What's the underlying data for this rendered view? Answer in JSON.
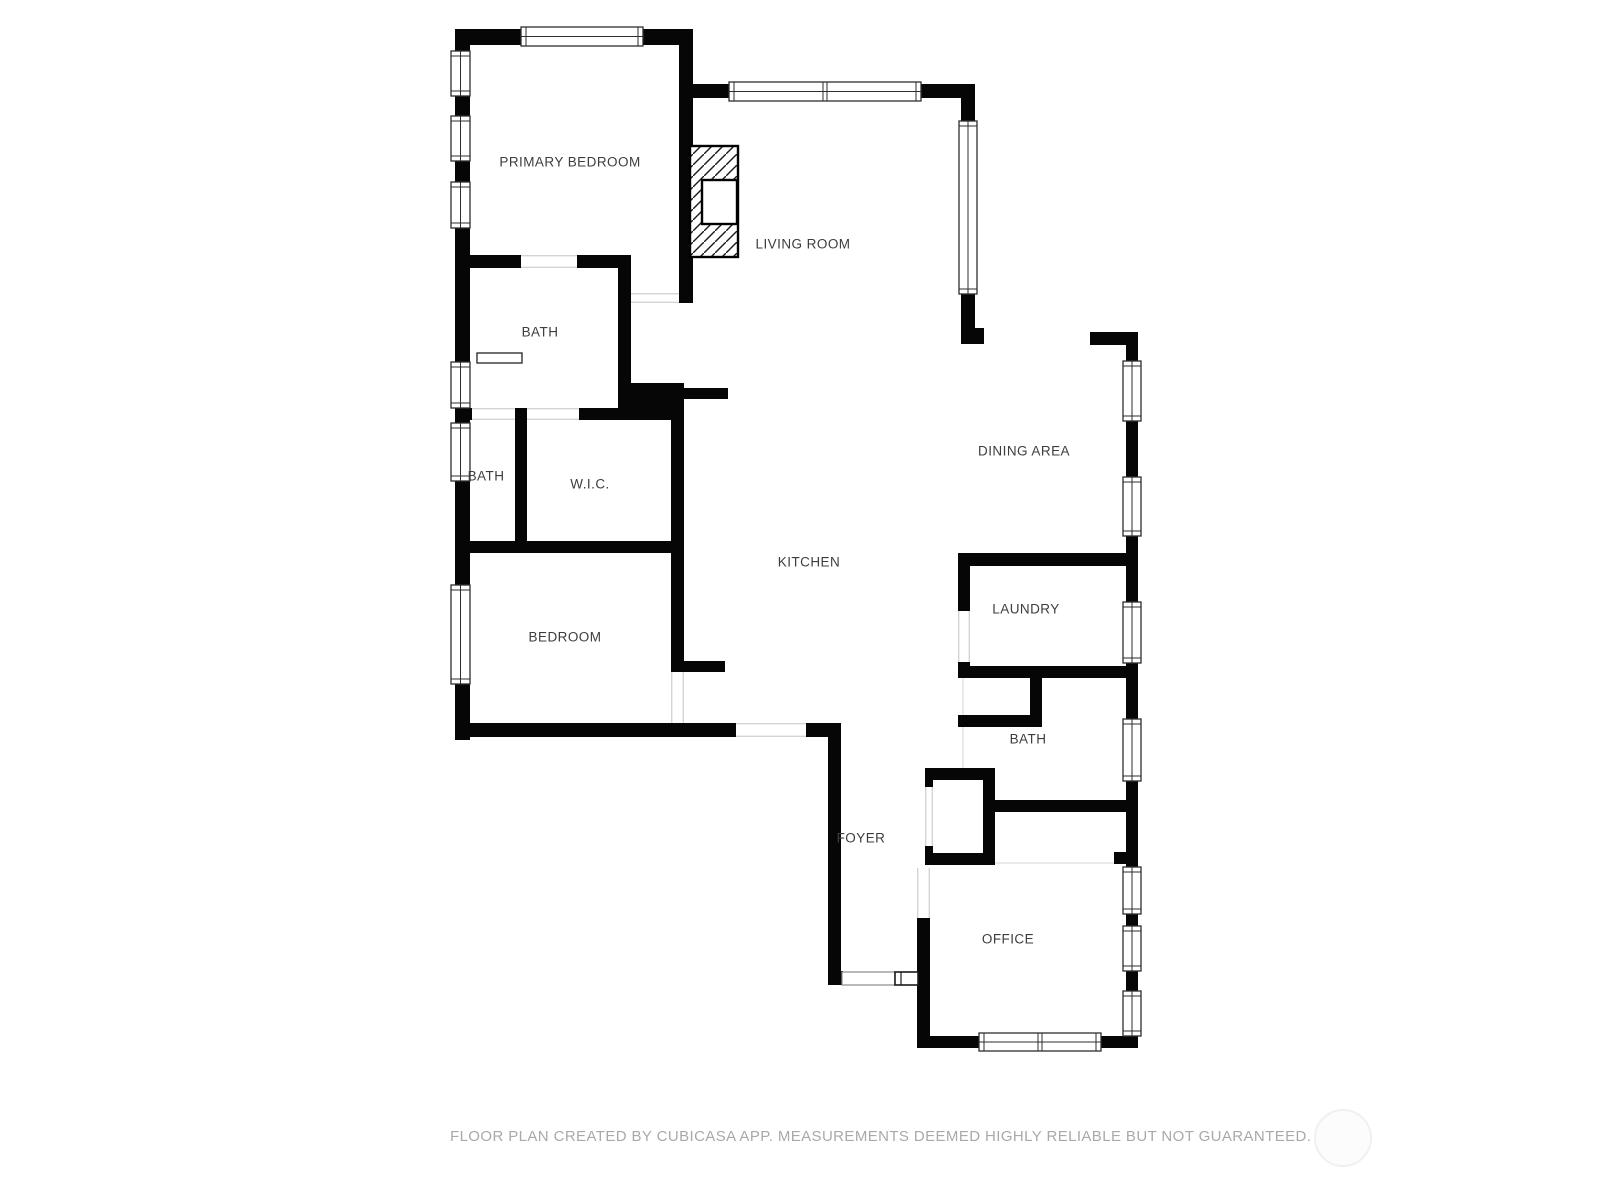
{
  "floor_plan": {
    "colors": {
      "wall": "#060606",
      "label_text": "#3d3d3d",
      "footer_text": "#a9a9a9",
      "background": "#ffffff",
      "window_outline": "#2e2e2e",
      "opening_edge": "#d4d4d4",
      "boundary_line": "#e3e3e3"
    },
    "rooms": [
      {
        "id": "primary-bedroom",
        "label": "PRIMARY BEDROOM",
        "x": 570,
        "y": 162
      },
      {
        "id": "living-room",
        "label": "LIVING ROOM",
        "x": 803,
        "y": 244
      },
      {
        "id": "bath-1",
        "label": "BATH",
        "x": 540,
        "y": 332
      },
      {
        "id": "bath-2",
        "label": "BATH",
        "x": 486,
        "y": 476
      },
      {
        "id": "wic",
        "label": "W.I.C.",
        "x": 590,
        "y": 484
      },
      {
        "id": "dining-area",
        "label": "DINING AREA",
        "x": 1024,
        "y": 451
      },
      {
        "id": "kitchen",
        "label": "KITCHEN",
        "x": 809,
        "y": 562
      },
      {
        "id": "bedroom",
        "label": "BEDROOM",
        "x": 565,
        "y": 637
      },
      {
        "id": "laundry",
        "label": "LAUNDRY",
        "x": 1026,
        "y": 609
      },
      {
        "id": "bath-3",
        "label": "BATH",
        "x": 1028,
        "y": 739
      },
      {
        "id": "foyer",
        "label": "FOYER",
        "x": 861,
        "y": 838
      },
      {
        "id": "office",
        "label": "OFFICE",
        "x": 1008,
        "y": 939
      }
    ],
    "walls": [
      [
        455,
        29,
        238,
        16
      ],
      [
        455,
        29,
        15,
        711
      ],
      [
        679,
        29,
        14,
        274
      ],
      [
        679,
        84,
        296,
        14
      ],
      [
        961,
        84,
        14,
        260
      ],
      [
        961,
        328,
        23,
        16
      ],
      [
        455,
        255,
        176,
        13
      ],
      [
        618,
        255,
        13,
        165
      ],
      [
        618,
        383,
        66,
        37
      ],
      [
        684,
        388,
        44,
        11
      ],
      [
        455,
        408,
        229,
        12
      ],
      [
        515,
        414,
        12,
        133
      ],
      [
        455,
        541,
        229,
        12
      ],
      [
        671,
        414,
        13,
        258
      ],
      [
        684,
        661,
        41,
        11
      ],
      [
        455,
        723,
        281,
        14
      ],
      [
        806,
        723,
        34,
        14
      ],
      [
        828,
        723,
        13,
        262
      ],
      [
        828,
        971,
        15,
        14
      ],
      [
        917,
        918,
        13,
        130
      ],
      [
        917,
        1036,
        221,
        12
      ],
      [
        1126,
        332,
        12,
        716
      ],
      [
        1090,
        332,
        48,
        13
      ],
      [
        958,
        553,
        180,
        13
      ],
      [
        958,
        553,
        12,
        58
      ],
      [
        958,
        662,
        12,
        16
      ],
      [
        958,
        666,
        180,
        12
      ],
      [
        1030,
        672,
        12,
        55
      ],
      [
        958,
        715,
        84,
        12
      ],
      [
        993,
        800,
        145,
        12
      ],
      [
        925,
        768,
        70,
        12
      ],
      [
        983,
        768,
        12,
        97
      ],
      [
        925,
        853,
        70,
        12
      ],
      [
        925,
        768,
        8,
        19
      ],
      [
        925,
        846,
        8,
        19
      ],
      [
        1114,
        852,
        12,
        12
      ]
    ],
    "windows": [
      {
        "r": [
          521,
          27,
          122,
          19
        ],
        "dir": "h"
      },
      {
        "r": [
          729,
          82,
          192,
          19
        ],
        "dir": "h",
        "div": 1
      },
      {
        "r": [
          451,
          51,
          19,
          45
        ],
        "dir": "v"
      },
      {
        "r": [
          451,
          116,
          19,
          45
        ],
        "dir": "v"
      },
      {
        "r": [
          451,
          182,
          19,
          46
        ],
        "dir": "v"
      },
      {
        "r": [
          451,
          362,
          19,
          46
        ],
        "dir": "v"
      },
      {
        "r": [
          451,
          423,
          19,
          58
        ],
        "dir": "v"
      },
      {
        "r": [
          451,
          585,
          19,
          99
        ],
        "dir": "v"
      },
      {
        "r": [
          959,
          121,
          18,
          173
        ],
        "dir": "v"
      },
      {
        "r": [
          1123,
          361,
          18,
          60
        ],
        "dir": "v"
      },
      {
        "r": [
          1123,
          477,
          18,
          59
        ],
        "dir": "v"
      },
      {
        "r": [
          1123,
          602,
          18,
          61
        ],
        "dir": "v"
      },
      {
        "r": [
          1123,
          719,
          18,
          62
        ],
        "dir": "v"
      },
      {
        "r": [
          1123,
          867,
          18,
          47
        ],
        "dir": "v"
      },
      {
        "r": [
          1123,
          926,
          18,
          45
        ],
        "dir": "v"
      },
      {
        "r": [
          1123,
          991,
          18,
          45
        ],
        "dir": "v"
      },
      {
        "r": [
          979,
          1033,
          122,
          18
        ],
        "dir": "h",
        "div": 1
      }
    ],
    "openings": [
      {
        "r": [
          521,
          255,
          56,
          13
        ],
        "dir": "h"
      },
      {
        "r": [
          631,
          293,
          48,
          10
        ],
        "dir": "h"
      },
      {
        "r": [
          472,
          408,
          43,
          12
        ],
        "dir": "h"
      },
      {
        "r": [
          527,
          408,
          52,
          12
        ],
        "dir": "h"
      },
      {
        "r": [
          671,
          672,
          13,
          51
        ],
        "dir": "v"
      },
      {
        "r": [
          736,
          723,
          70,
          14
        ],
        "dir": "h"
      },
      {
        "r": [
          958,
          611,
          12,
          51
        ],
        "dir": "v"
      },
      {
        "r": [
          925,
          787,
          8,
          59
        ],
        "dir": "v"
      },
      {
        "r": [
          917,
          868,
          13,
          50
        ],
        "dir": "v"
      }
    ],
    "boundaries": [
      [
        963,
        678,
        963,
        768
      ],
      [
        930,
        863,
        1114,
        863
      ]
    ],
    "fireplace": {
      "outer": [
        690,
        146,
        48,
        111
      ],
      "inner": [
        702,
        180,
        35,
        44
      ]
    },
    "fixtures": {
      "shelf": [
        477,
        353,
        45,
        10
      ],
      "entry_sidelight": [
        842,
        972,
        53,
        13
      ],
      "entry_door": [
        895,
        972,
        23,
        13
      ]
    },
    "footer": "FLOOR PLAN CREATED BY CUBICASA APP. MEASUREMENTS DEEMED HIGHLY RELIABLE BUT NOT GUARANTEED.",
    "watermark": {
      "cx": 1341,
      "cy": 1136,
      "r": 27
    }
  }
}
